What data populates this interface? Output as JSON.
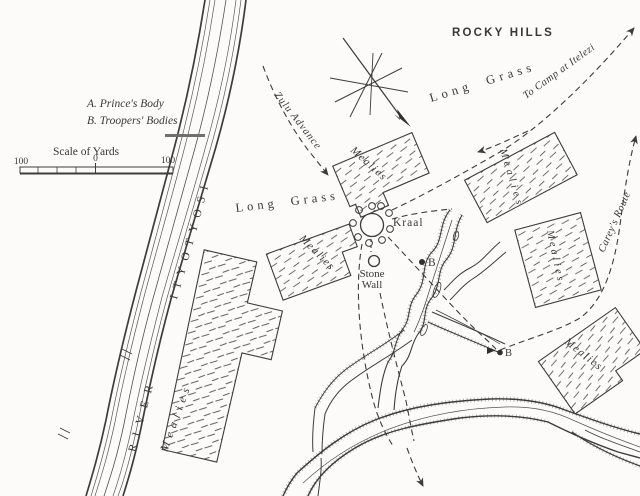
{
  "legend": {
    "item_a": "A. Prince's Body",
    "item_b": "B. Troopers' Bodies",
    "scale_title": "Scale of Yards",
    "scale_left": "100",
    "scale_zero": "0",
    "scale_right": "100"
  },
  "labels": {
    "rocky_hills": "ROCKY HILLS",
    "long_grass_ne": "Long Grass",
    "long_grass_w": "Long Grass",
    "to_camp": "To Camp at Itelezi",
    "zulu_advance": "Zulu Advance",
    "careys_route": "Carey's Route",
    "kraal": "Kraal",
    "stone_wall_1": "Stone",
    "stone_wall_2": "Wall"
  },
  "river": {
    "word": "RIVER",
    "name": "ITYOTYOSI"
  },
  "mealies": {
    "m1": "Mealies",
    "m2": "Mealies",
    "m3": "Mealies",
    "m4": "Mealies",
    "m5": "Mealies",
    "m6": "Mealies"
  },
  "markers": {
    "kraal_b": "B",
    "donga_b": "B"
  },
  "colors": {
    "ink": "#3c3c3c",
    "paper": "#fcfbf9"
  }
}
